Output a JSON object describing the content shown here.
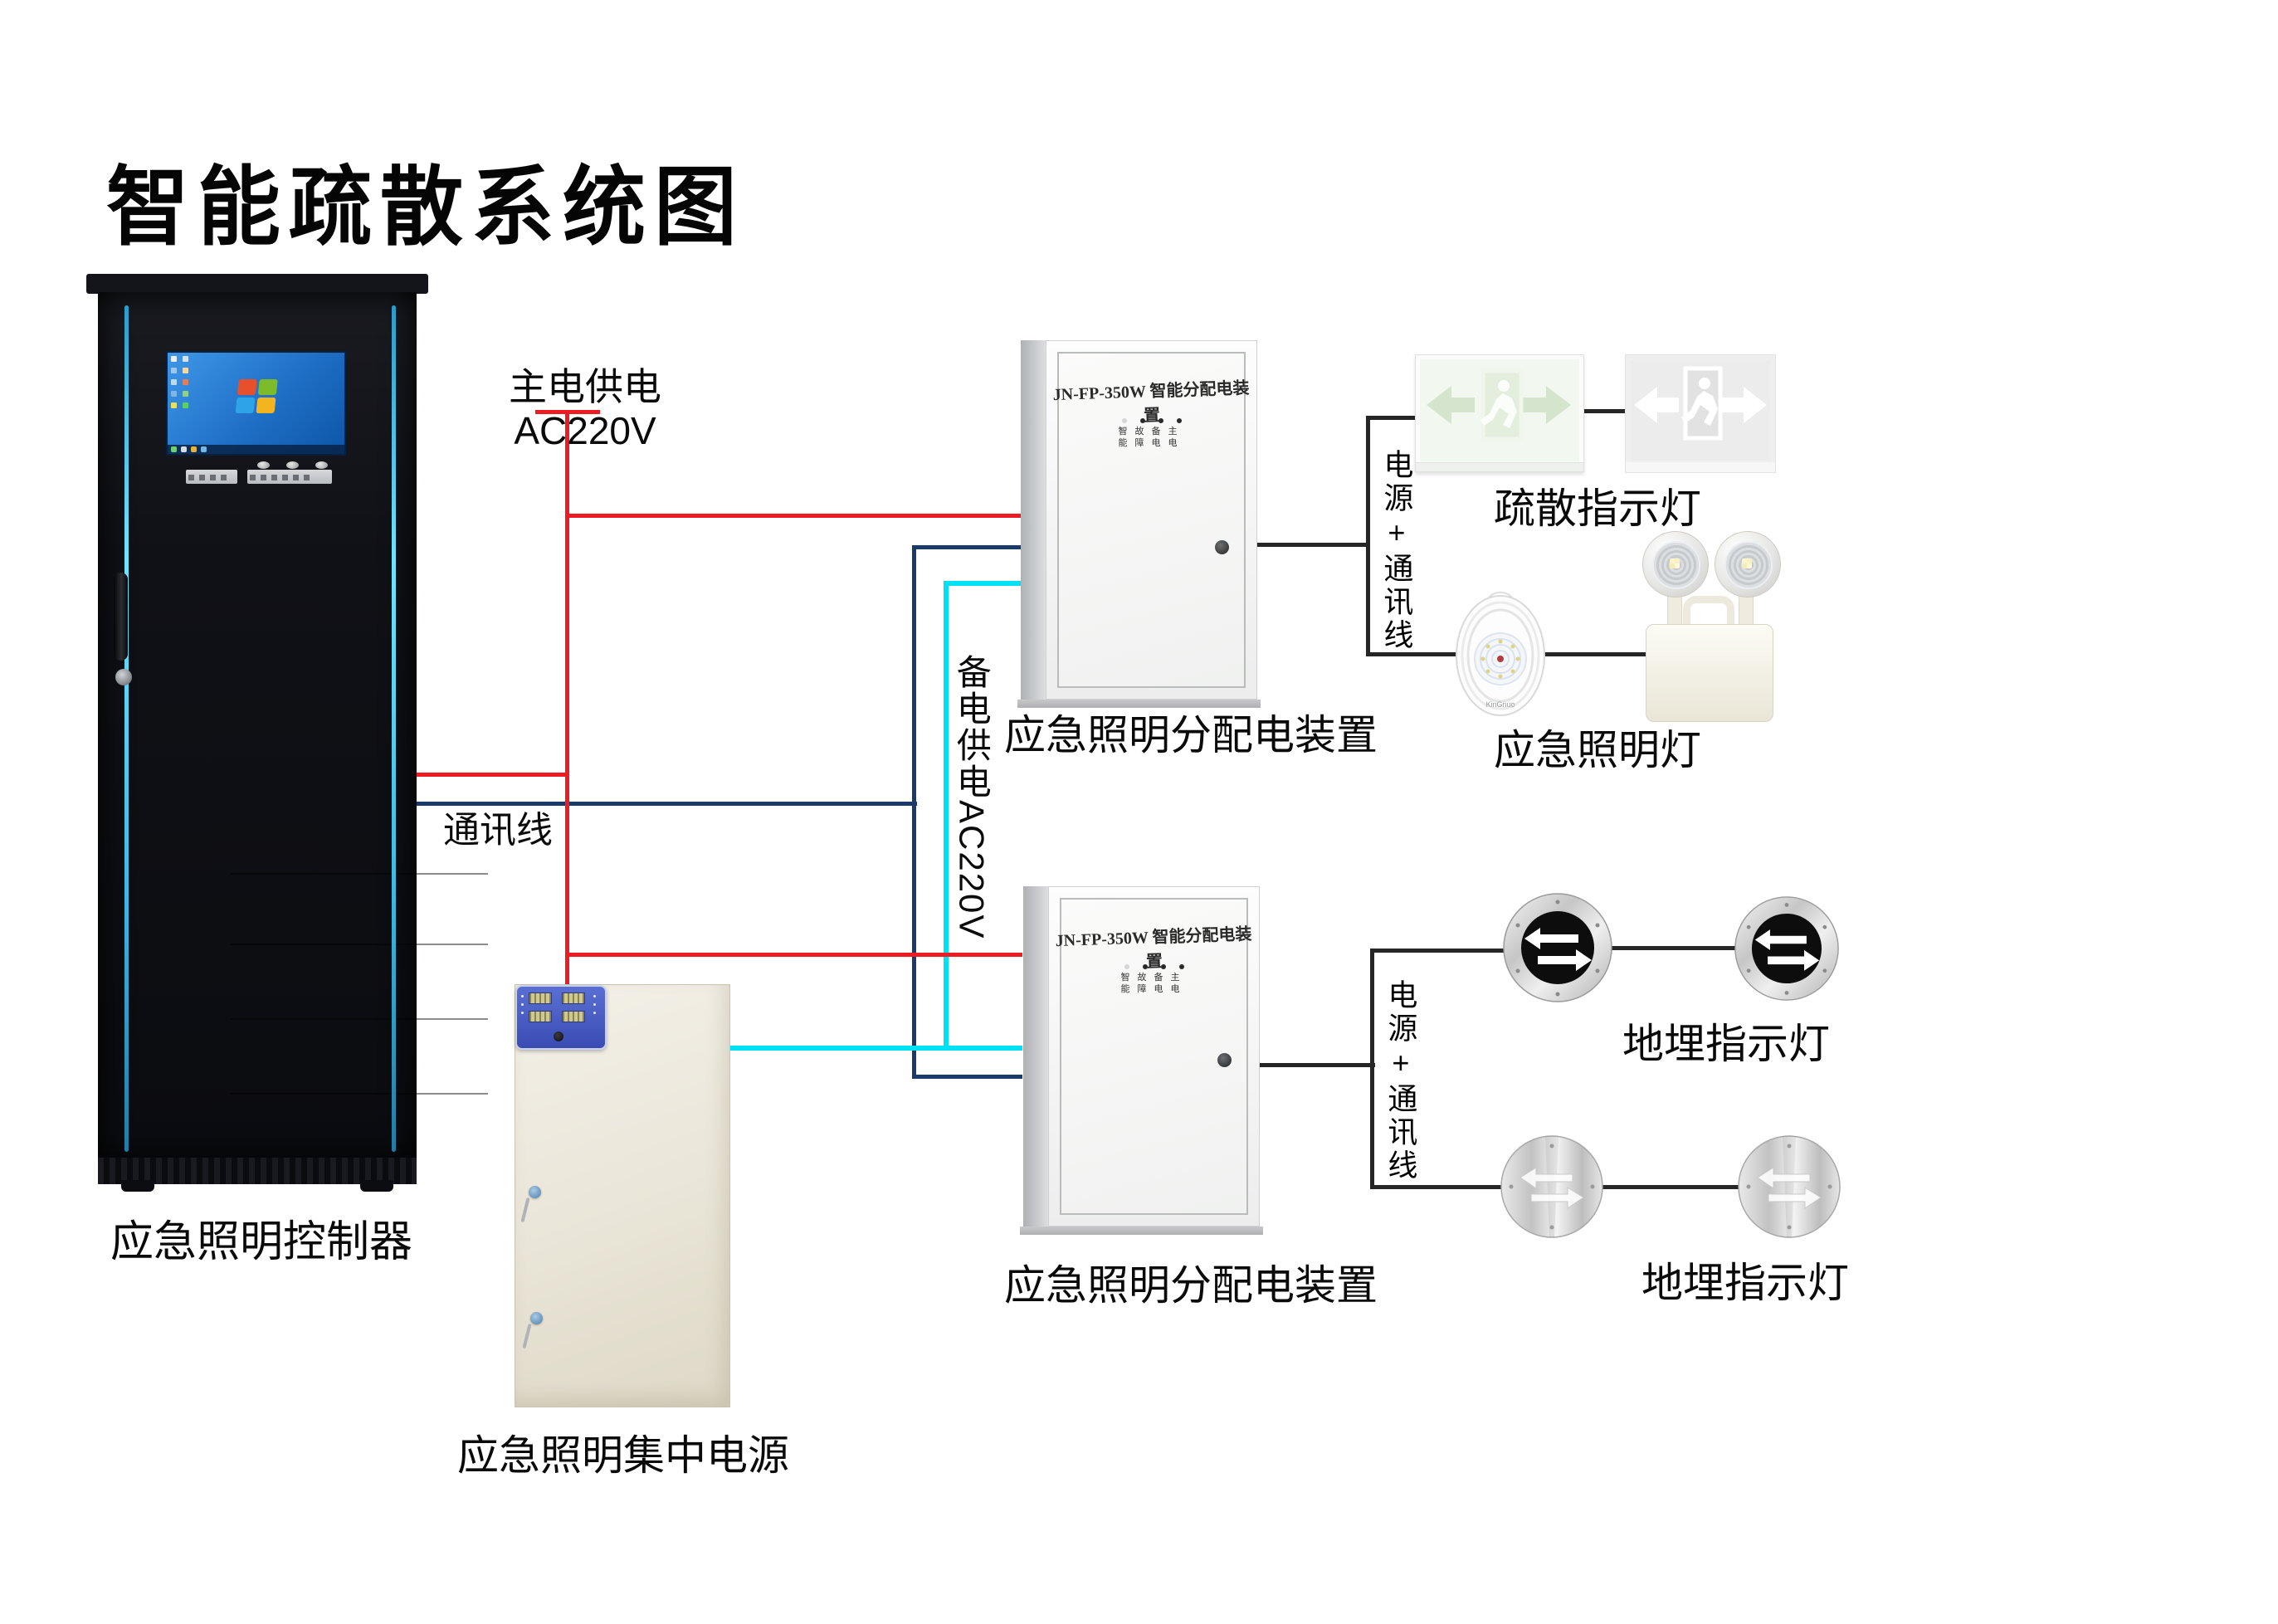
{
  "title": "智能疏散系统图",
  "colors": {
    "main_power_wire": "#ed1c24",
    "comm_wire": "#1a3a69",
    "backup_power_wire": "#00e1f4",
    "connector_wire": "#262626",
    "cabinet_glow": "#4fd4f2",
    "psu_panel": "#4456c7"
  },
  "cabinet": {
    "label": "应急照明控制器"
  },
  "wire_labels": {
    "main_power": "主电供电AC220V",
    "comm": "通讯线",
    "backup_power": "备电供电AC220V"
  },
  "power_supply": {
    "label": "应急照明集中电源"
  },
  "distribution_box_1": {
    "panel_title": "JN-FP-350W 智能分配电装置",
    "led_row_1": "智故备主",
    "led_row_2": "能障电电",
    "label": "应急照明分配电装置",
    "bracket_label": "电源+通讯线"
  },
  "distribution_box_2": {
    "panel_title": "JN-FP-350W 智能分配电装置",
    "led_row_1": "智故备主",
    "led_row_2": "能障电电",
    "label": "应急照明分配电装置",
    "bracket_label": "电源+通讯线"
  },
  "devices": {
    "exit_sign_label": "疏散指示灯",
    "emergency_light_label": "应急照明灯",
    "ground_light_label_1": "地埋指示灯",
    "ground_light_label_2": "地埋指示灯",
    "round_lamp_brand": "KinGnuo"
  }
}
